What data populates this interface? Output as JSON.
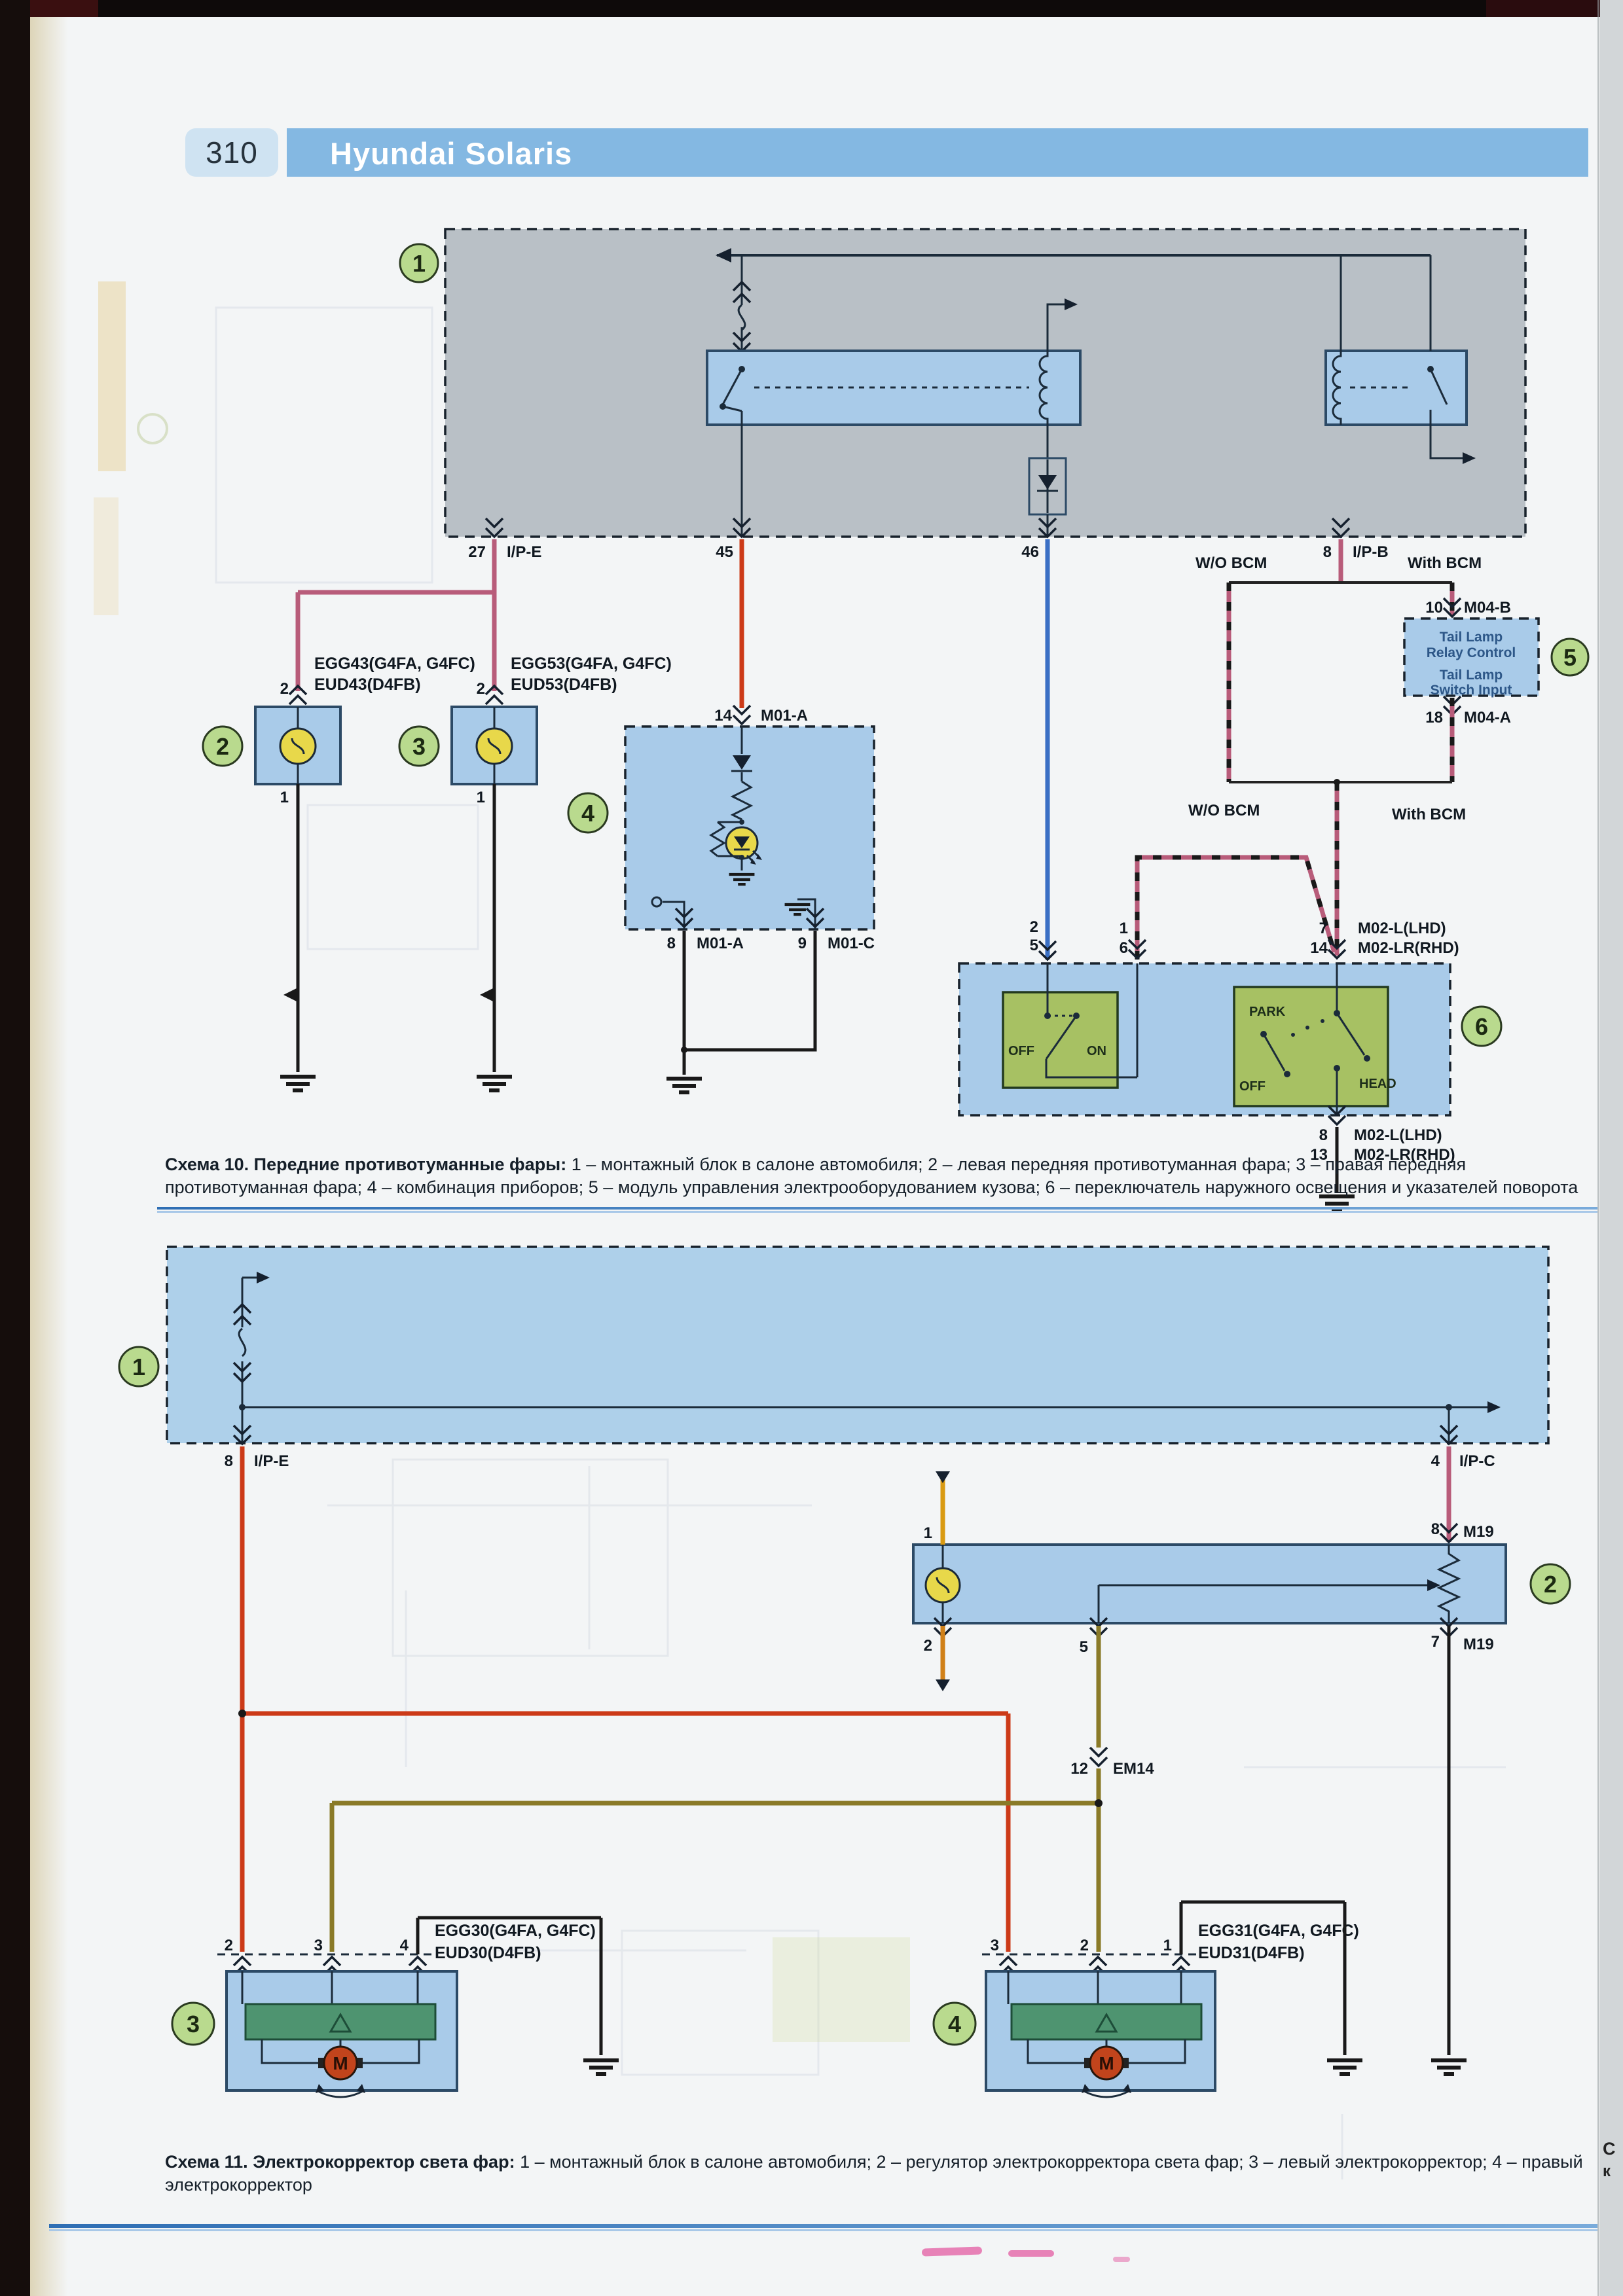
{
  "page": {
    "number": "310",
    "brand": "Hyundai Solaris",
    "side_fragment_top": "С",
    "side_fragment_bottom": "к"
  },
  "colors": {
    "header_bar": "#84b8e2",
    "page_badge_bg": "#cfe3f2",
    "box_fill_blue": "#a9cbe9",
    "box_fill_gray": "#b9c0c6",
    "callout_green": "#b9da8e",
    "switch_green": "#a7c163",
    "corrector_bar_green": "#4e9470",
    "bulb_yellow": "#e8d84a",
    "motor_red": "#c2441c",
    "wire_pink": "#b85c7a",
    "wire_red": "#cc3a18",
    "wire_blue": "#3a6fc4",
    "wire_olive": "#8a7a28",
    "wire_orange": "#d99a12",
    "separator_blue": "#2e6eb4"
  },
  "captions": {
    "c10_title": "Схема 10. Передние противотуманные фары:",
    "c10_body": " 1 – монтажный блок в салоне автомобиля; 2 – левая передняя противотуманная фара; 3 – правая передняя противотуманная фара; 4 – комбинация приборов; 5 – модуль управления электрооборудованием кузова; 6 – переключатель наружного освещения и указателей поворота",
    "c11_title": "Схема 11. Электрокорректор света фар:",
    "c11_body": " 1 – монтажный блок в салоне автомобиля; 2 – регулятор электрокорректора света фар; 3 – левый электрокорректор; 4 – правый электрокорректор"
  },
  "d10": {
    "callout1": "1",
    "callout2": "2",
    "callout3": "3",
    "callout4": "4",
    "callout5": "5",
    "callout6": "6",
    "pin27": "27",
    "name_ipe": "I/P-E",
    "pin45": "45",
    "pin46": "46",
    "pin8": "8",
    "name_ipb": "I/P-B",
    "egg43": "EGG43(G4FA, G4FC)",
    "eud43": "EUD43(D4FB)",
    "egg53": "EGG53(G4FA, G4FC)",
    "eud53": "EUD53(D4FB)",
    "lampL_top": "2",
    "lampL_bot": "1",
    "lampR_top": "2",
    "lampR_bot": "1",
    "pin14": "14",
    "name_m01a": "M01-A",
    "pin8m": "8",
    "name_m01a2": "M01-A",
    "pin9": "9",
    "name_m01c": "M01-C",
    "wo_bcm": "W/O BCM",
    "with_bcm": "With BCM",
    "wo_bcm2": "W/O BCM",
    "with_bcm2": "With BCM",
    "pin10": "10",
    "name_m04b": "M04-B",
    "bcm1": "Tail Lamp",
    "bcm2": "Relay Control",
    "bcm3": "Tail Lamp",
    "bcm4": "Switch Input",
    "pin18": "18",
    "name_m04a": "M04-A",
    "pin2": "2",
    "pin5": "5",
    "pin1": "1",
    "pin6": "6",
    "pin7": "7",
    "name_m02l": "M02-L(LHD)",
    "pin14b": "14",
    "name_m02lr": "M02-LR(RHD)",
    "pin8b": "8",
    "name_m02l2": "M02-L(LHD)",
    "pin13": "13",
    "name_m02lr2": "M02-LR(RHD)",
    "sw_off": "OFF",
    "sw_on": "ON",
    "sw_park": "PARK",
    "sw_off2": "OFF",
    "sw_head": "HEAD"
  },
  "d11": {
    "callout1": "1",
    "callout2": "2",
    "callout3": "3",
    "callout4": "4",
    "pin8": "8",
    "name_ipe": "I/P-E",
    "pin4": "4",
    "name_ipc": "I/P-C",
    "pin1": "1",
    "pin8m": "8",
    "name_m19": "M19",
    "pin2": "2",
    "pin5": "5",
    "pin7": "7",
    "name_m19b": "M19",
    "pin12": "12",
    "name_em14": "EM14",
    "egg30": "EGG30(G4FA, G4FC)",
    "eud30": "EUD30(D4FB)",
    "p3_2": "2",
    "p3_3": "3",
    "p3_4": "4",
    "egg31": "EGG31(G4FA, G4FC)",
    "eud31": "EUD31(D4FB)",
    "p4_3": "3",
    "p4_2": "2",
    "p4_1": "1",
    "motorL": "M",
    "motorR": "M"
  }
}
